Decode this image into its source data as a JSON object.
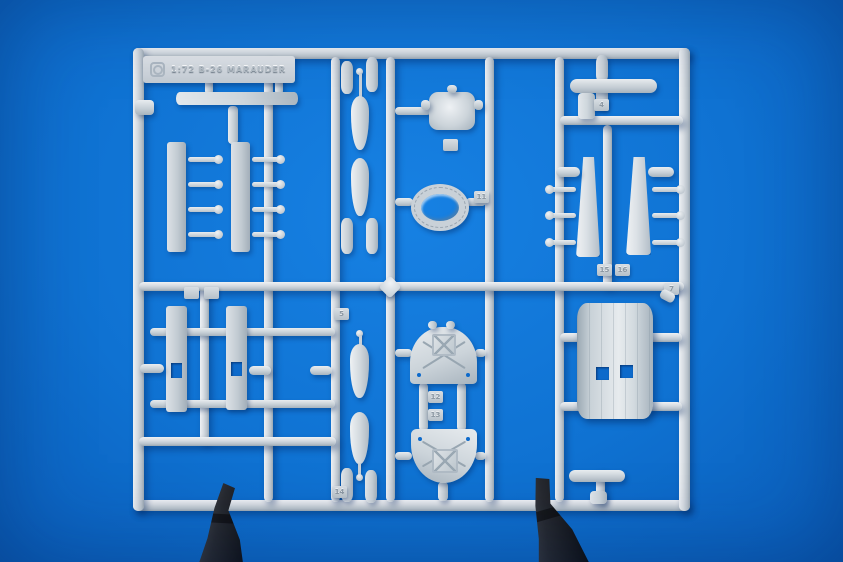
{
  "scene": {
    "subject": "grey injection-molded plastic model kit sprue held by two black clips on a blue background",
    "label_text": "1:72 B-26 MARAUDER",
    "colors": {
      "background_blue": "#0f72d2",
      "background_edge_blue": "#0a5cb8",
      "plastic_grey": "#ced6dc",
      "plastic_highlight": "#eef1f4",
      "plastic_shadow": "#9aa7b2",
      "clip_black": "#26292f"
    },
    "tags": {
      "t4": "4",
      "t5": "5",
      "t7": "7",
      "t11": "11",
      "t12": "12",
      "t13": "13",
      "t14": "14",
      "t15": "15",
      "t16": "16"
    }
  }
}
